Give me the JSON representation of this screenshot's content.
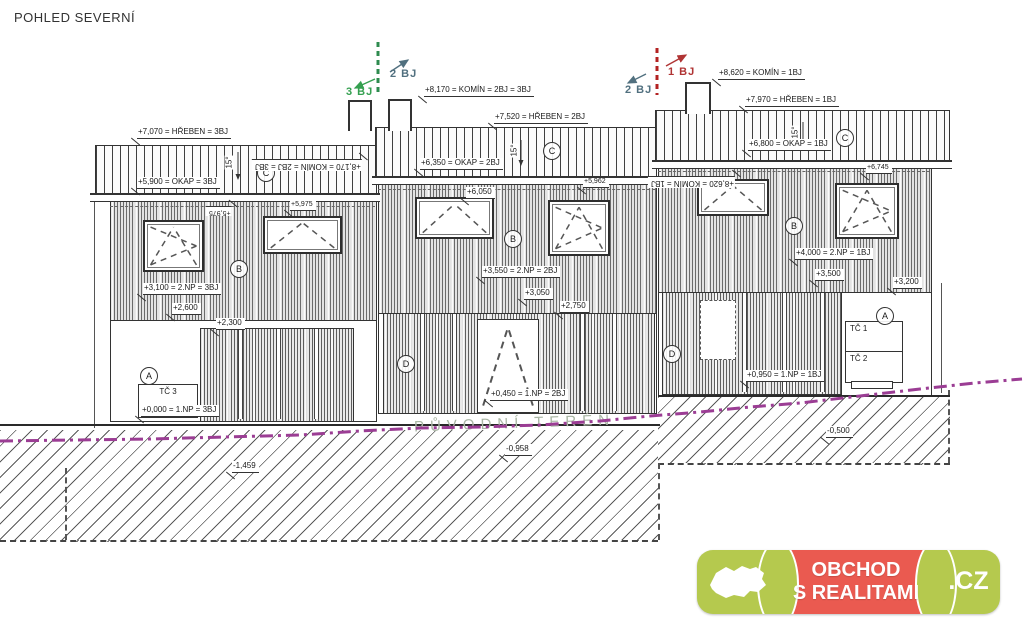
{
  "title": "POHLED SEVERNÍ",
  "unit_markers": {
    "u3": "3 BJ",
    "u2": "2 BJ",
    "u1": "1 BJ"
  },
  "dims": [
    "+7,070 = HŘEBEN = 3BJ",
    "+5,900 = OKAP = 3BJ",
    "+8,170 = KOMÍN = 2BJ = 3BJ",
    "+7,520 = HŘEBEN = 2BJ",
    "+6,350 = OKAP = 2BJ",
    "+8,620 = KOMÍN = 1BJ",
    "+7,970 = HŘEBEN = 1BJ",
    "+6,800 = OKAP = 1BJ",
    "+3,100 = 2.NP = 3BJ",
    "+2,600",
    "+2,300",
    "+3,550 = 2.NP = 2BJ",
    "+3,050",
    "+2,750",
    "+4,000 = 2.NP = 1BJ",
    "+3,500",
    "+3,200",
    "+0,000 = 1.NP = 3BJ",
    "+0,450 = 1.NP = 2BJ",
    "+0,950 = 1.NP = 1BJ",
    "-1,459",
    "-0,958",
    "-0,500",
    "+6,050",
    "+5,975",
    "+5,962",
    "+6,745"
  ],
  "rotated_dims": [
    "+8,170 = KOMÍN = 2BJ = 3BJ",
    "+8,620 = KOMÍN = 1BJ",
    "+5,975"
  ],
  "grid_bubbles": [
    "A",
    "A",
    "B",
    "B",
    "B",
    "C",
    "C",
    "C",
    "D",
    "D"
  ],
  "slope_label": "15°",
  "equipment": {
    "tc1": "TČ 1",
    "tc2": "TČ 2",
    "tc3": "TČ 3"
  },
  "terrain_label": "PŮVODNÍ TERÉN",
  "watermark": {
    "line1": "OBCHOD",
    "line2": "S REALITAMI",
    "suffix": ".CZ"
  },
  "colors": {
    "terrain_line": "#9b3d94",
    "unit3_green": "#35a050",
    "unit2_slate": "#51707f",
    "unit1_red": "#b03434",
    "logo_green": "#b5c94e",
    "logo_red": "#ea5a50"
  }
}
